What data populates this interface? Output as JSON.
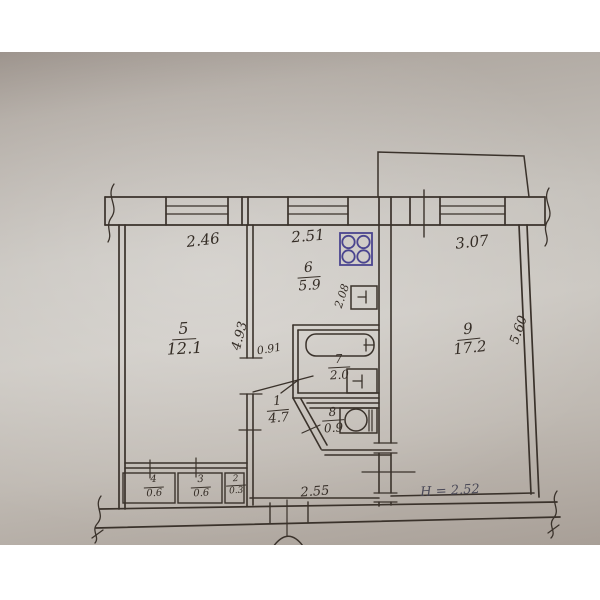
{
  "document": {
    "kind": "hand-drawn apartment floor plan (photo of paper)",
    "ink_color": "#3a322b",
    "stove_ink_color": "#4a458f",
    "paper_color": "#c6c2bc"
  },
  "rooms": [
    {
      "number": "5",
      "area": "12.1"
    },
    {
      "number": "6",
      "area": "5.9"
    },
    {
      "number": "9",
      "area": "17.2"
    },
    {
      "number": "7",
      "area": "2.0"
    },
    {
      "number": "1",
      "area": "4.7"
    },
    {
      "number": "8",
      "area": "0.9"
    },
    {
      "number": "4",
      "area": "0.6"
    },
    {
      "number": "3",
      "area": "0.6"
    },
    {
      "number": "2",
      "area": "0.3"
    }
  ],
  "dimensions": {
    "top": [
      "2.46",
      "2.51",
      "3.07"
    ],
    "bottom": "2.55",
    "door": "0.91",
    "left_inner": "4.93",
    "kitchen_inner": "2.08",
    "right_outer": "5.60",
    "ceiling_height": "H = 2.52"
  },
  "fixtures": [
    "stove",
    "kitchen sink",
    "bathtub",
    "washbasin",
    "toilet"
  ]
}
